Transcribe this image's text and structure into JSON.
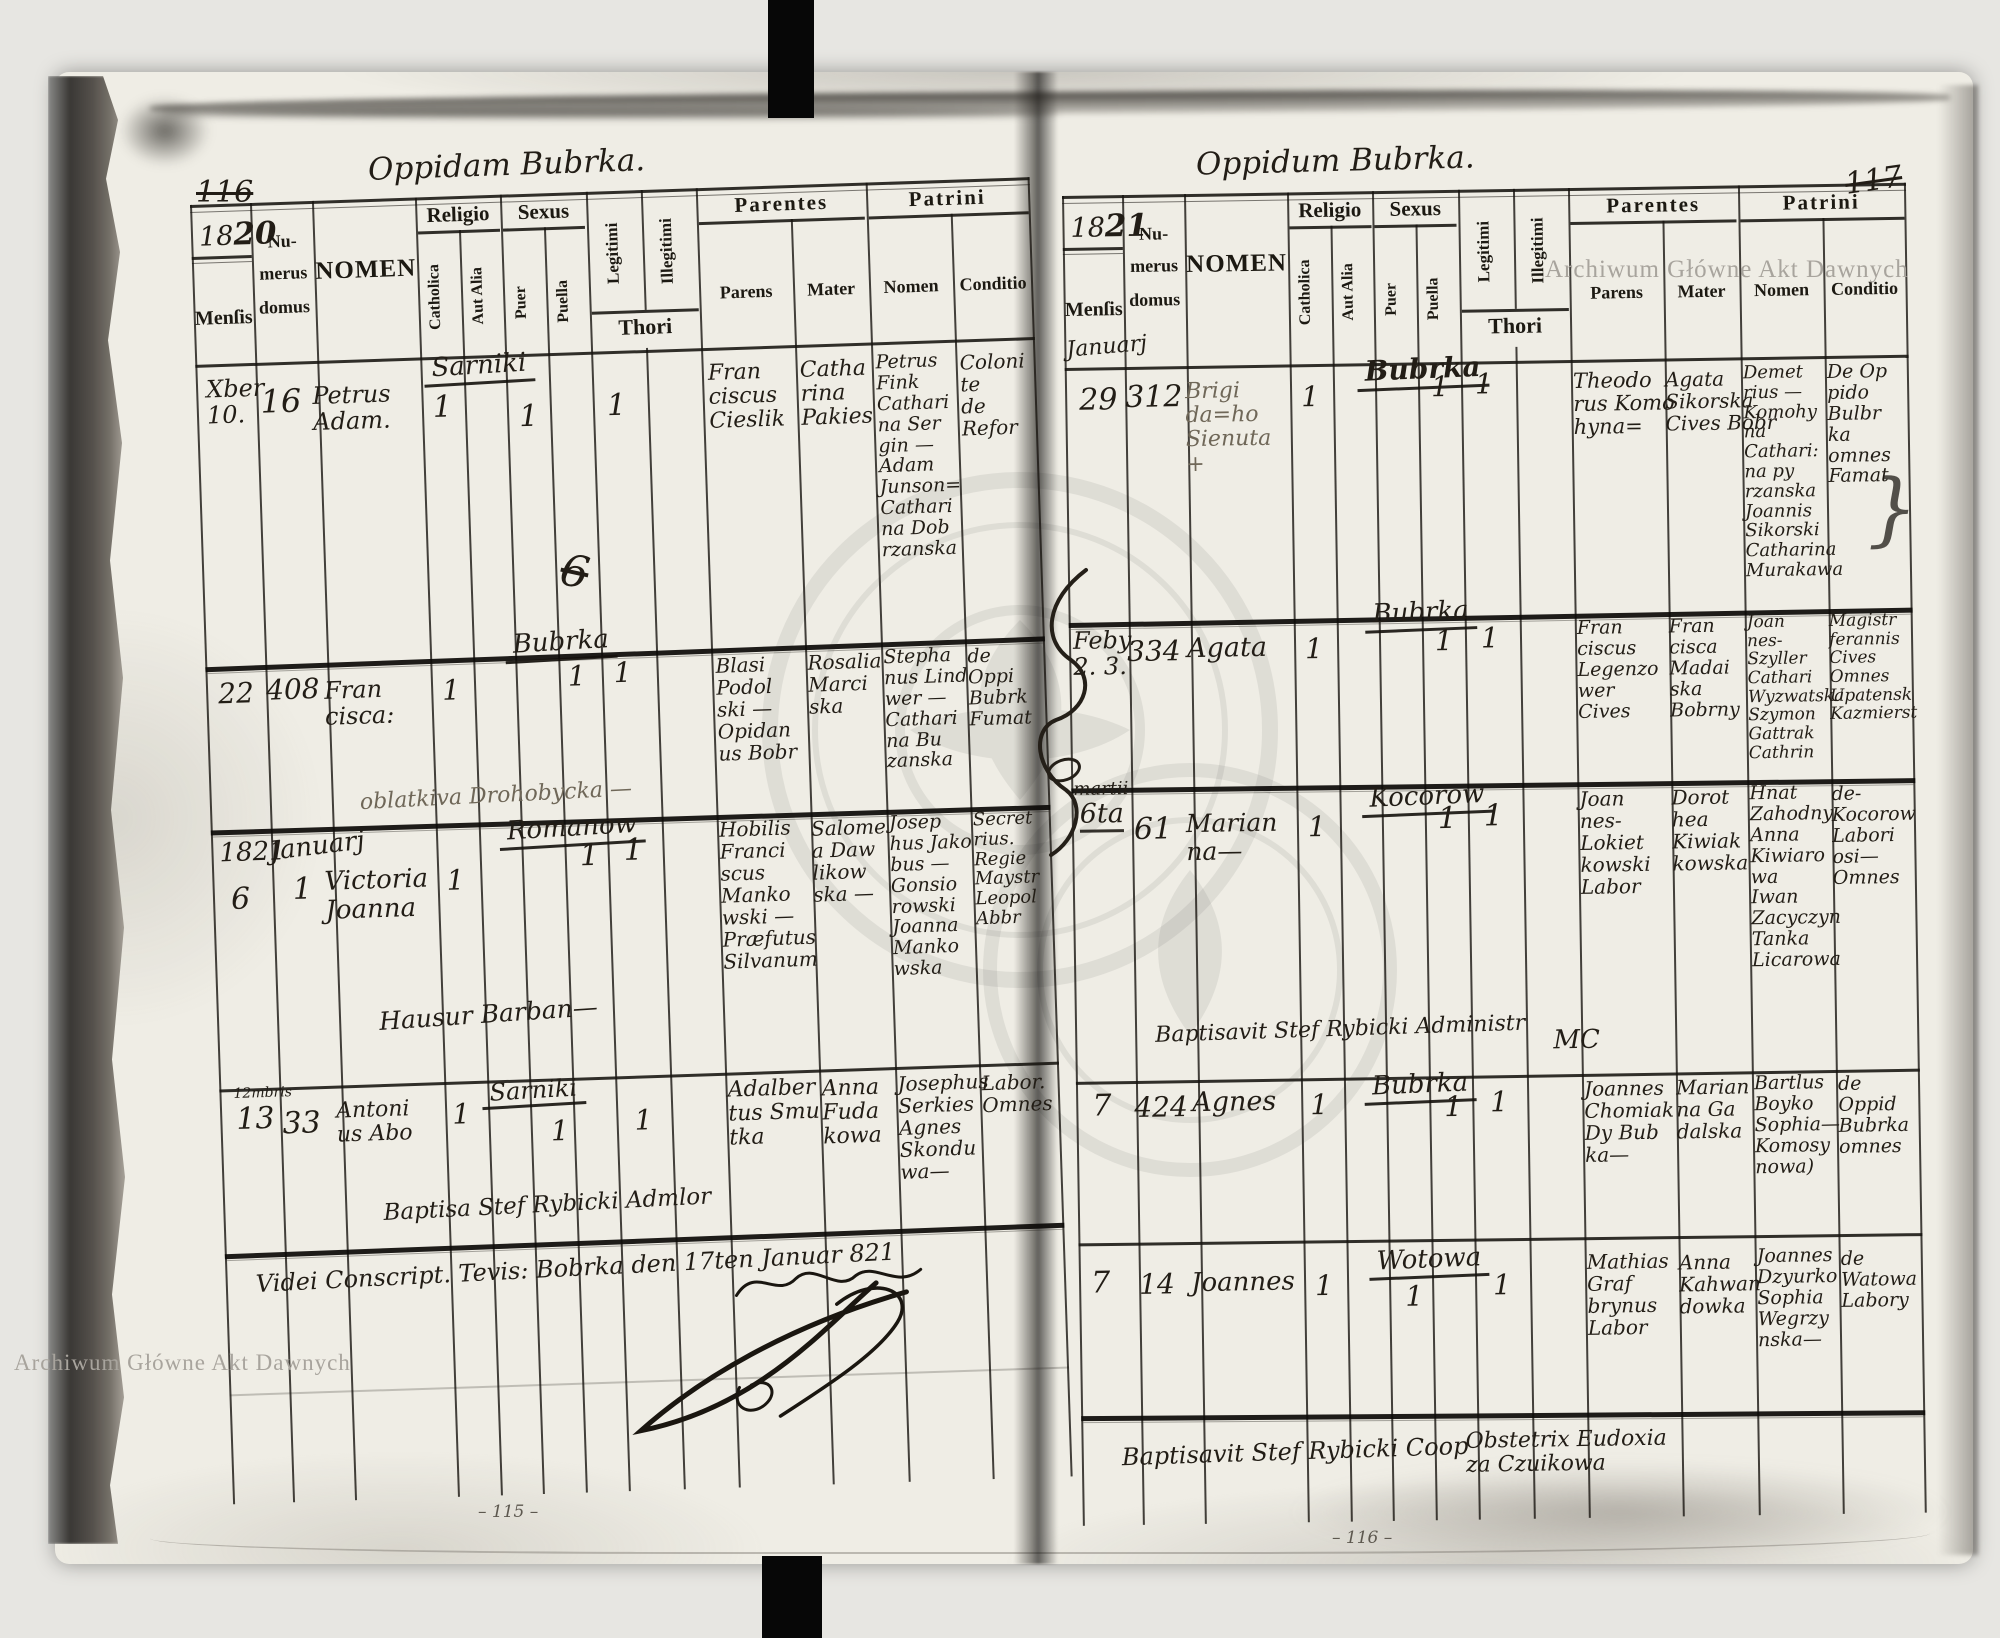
{
  "watermark": {
    "text": "Archiwum Główne Akt Dawnych"
  },
  "headers": {
    "mensis": "Menſis",
    "numerus_line1": "Nu-",
    "numerus_line2": "merus",
    "numerus_line3": "domus",
    "nomen": "NOMEN",
    "religio": "Religio",
    "catholica": "Catholica",
    "aut_alia": "Aut Alia",
    "sexus": "Sexus",
    "puer": "Puer",
    "puella": "Puella",
    "legitimi": "Legitimi",
    "illegitimi": "Illegitimi",
    "thori": "Thori",
    "parentes": "Parentes",
    "parens": "Parens",
    "mater": "Mater",
    "patrini": "Patrini",
    "patrini_nomen": "Nomen",
    "conditio": "Conditio"
  },
  "left_page": {
    "corner_number": "116",
    "title": "Oppidam Bubrka.",
    "year_print": "18",
    "year_hand": "20",
    "rows": [
      {
        "mensis": "Xber\n10.",
        "domus": "16",
        "nomen": "Petrus\nAdam.",
        "catholica": "1",
        "place": "Sarniki",
        "sexus_mark": "1",
        "legitimi": "1",
        "crossed_note": "6",
        "parens": "Fran\nciscus\nCieslik",
        "mater": "Catha\nrina\nPakies",
        "patrini_nomen": "Petrus\nFink\nCathari\nna Ser\ngin —\nAdam\nJunson=\nCathari\nna Dob\nrzanska",
        "conditio": "Coloni\nte\nde\nRefor"
      },
      {
        "mensis": "22",
        "domus": "408",
        "nomen": "Fran\ncisca:",
        "catholica": "1",
        "place": "Bubrka",
        "sexus_mark": "1",
        "legitimi": "1",
        "parens": "Blasi\nPodol\nski —\nOpidan\nus Bobr",
        "mater": "Rosalia\nMarci\nska",
        "patrini_nomen": "Stepha\nnus Lind\nwer —\nCathari\nna Bu\nzanska",
        "conditio": "de\nOppi\nBubrk\nFumat",
        "annotation": "oblatkiva Drohobycka —"
      },
      {
        "year_note": "1821",
        "month_note": "Januarj",
        "mensis": "6",
        "domus": "1",
        "nomen": "Victoria\nJoanna",
        "catholica": "1",
        "place": "Romanow",
        "sexus_mark": "1",
        "legitimi": "1",
        "parens": "Hobilis\nFranci\nscus\nManko\nwski —\nPræfutus\nSilvanum",
        "mater": "Salome\na Daw\nlikow\nska —",
        "patrini_nomen": "Josep\nhus Jako\nbus —\nGonsio\nrowski\nJoanna\nManko\nwska",
        "conditio": "Secret\nrius.\nRegie\nMaystr\nLeopol\nAbbr",
        "annotation": "Hausur Barban—"
      },
      {
        "small_note": "12mbris",
        "mensis": "13",
        "domus": "33",
        "nomen": "Antoni\nus Abo",
        "catholica": "1",
        "place": "Sarniki",
        "sexus_mark": "1",
        "legitimi": "1",
        "parens": "Adalber\ntus Smu\ntka",
        "mater": "Anna\nFuda\nkowa",
        "patrini_nomen": "Josephus\nSerkies\nAgnes\nSkondu\nwa—",
        "conditio": "Labor.\nOmnes",
        "annotation": "Baptisa Stef Rybicki Admlor"
      }
    ],
    "footer_line": "Videi Conscript. Tevis: Bobrka den 17ten Januar 821",
    "bottom_number": "– 115 –"
  },
  "right_page": {
    "corner_number": "117",
    "title": "Oppidum Bubrka.",
    "year_print": "18",
    "year_hand": "21",
    "month_note": "Januarj",
    "rows": [
      {
        "mensis": "29",
        "domus": "312",
        "nomen": "Brigi\nda=ho\nSienuta\n+",
        "catholica": "1",
        "place": "Bubrka",
        "sexus_mark": "1",
        "legitimi": "1",
        "parens": "Theodo\nrus Komo\nhyna=",
        "mater": "Agata\nSikorska\nCives Bobr",
        "patrini_nomen": "Demet\nrius —\nKomohy\nna\nCathari:\nna py\nrzanska\nJoannis\nSikorski\nCatharina\nMurakawa",
        "conditio": "De Op\npido\nBulbr\nka\nomnes\nFamat",
        "bracket": "}"
      },
      {
        "mensis": "Feby\n2. 3.",
        "domus": "334",
        "nomen": "Agata",
        "catholica": "1",
        "place": "Bubrka",
        "sexus_mark": "1",
        "legitimi": "1",
        "parens": "Fran\nciscus\nLegenzo\nwer\nCives",
        "mater": "Fran\ncisca\nMadai\nska\nBobrny",
        "patrini_nomen": "Joan\nnes-\nSzyller\nCathari\nWyzwatska\nSzymon\nGattrak\nCathrin",
        "conditio": "Magistr\nferannis\nCives\nOmnes\nUpatensk\nKazmierst"
      },
      {
        "month_note": "martii",
        "mensis": "6ta",
        "domus": "61",
        "nomen": "Marian\nna—",
        "catholica": "1",
        "place": "Kocorow",
        "sexus_mark": "1",
        "legitimi": "1",
        "parens": "Joan\nnes-\nLokiet\nkowski\nLabor",
        "mater": "Dorot\nhea\nKiwiak\nkowska",
        "patrini_nomen": "Hnat\nZahodny\nAnna\nKiwiaro\nwa\nIwan\nZacyczyn\nTanka\nLicarowa",
        "conditio": "de-\nKocorow\nLabori\nosi—\nOmnes",
        "annotation": "Baptisavit Stef Rybicki Administr",
        "annotation2": "MC"
      },
      {
        "mensis": "7",
        "domus": "424",
        "nomen": "Agnes",
        "catholica": "1",
        "place": "Bubrka",
        "sexus_mark": "1",
        "legitimi": "1",
        "parens": "Joannes\nChomiak\nDy Bub\nka—",
        "mater": "Marian\nna Ga\ndalska",
        "patrini_nomen": "Bartlus\nBoyko\nSophia—\nKomosy\nnowa)",
        "conditio": "de\nOppid\nBubrka\nomnes"
      },
      {
        "mensis": "7",
        "domus": "14",
        "nomen": "Joannes",
        "catholica": "1",
        "place": "Wotowa",
        "sexus_mark": "1",
        "legitimi": "1",
        "parens": "Mathias\nGraf\nbrynus\nLabor",
        "mater": "Anna\nKahwan\ndowka",
        "patrini_nomen": "Joannes\nDzyurko\nSophia\nWegrzy\nnska—",
        "conditio": "de\nWatowa\nLabory"
      }
    ],
    "footer_note1": "Baptisavit Stef Rybicki Coop",
    "footer_note2": "Obstetrix Eudoxia\nza Czuikowa",
    "bottom_number": "– 116 –"
  }
}
